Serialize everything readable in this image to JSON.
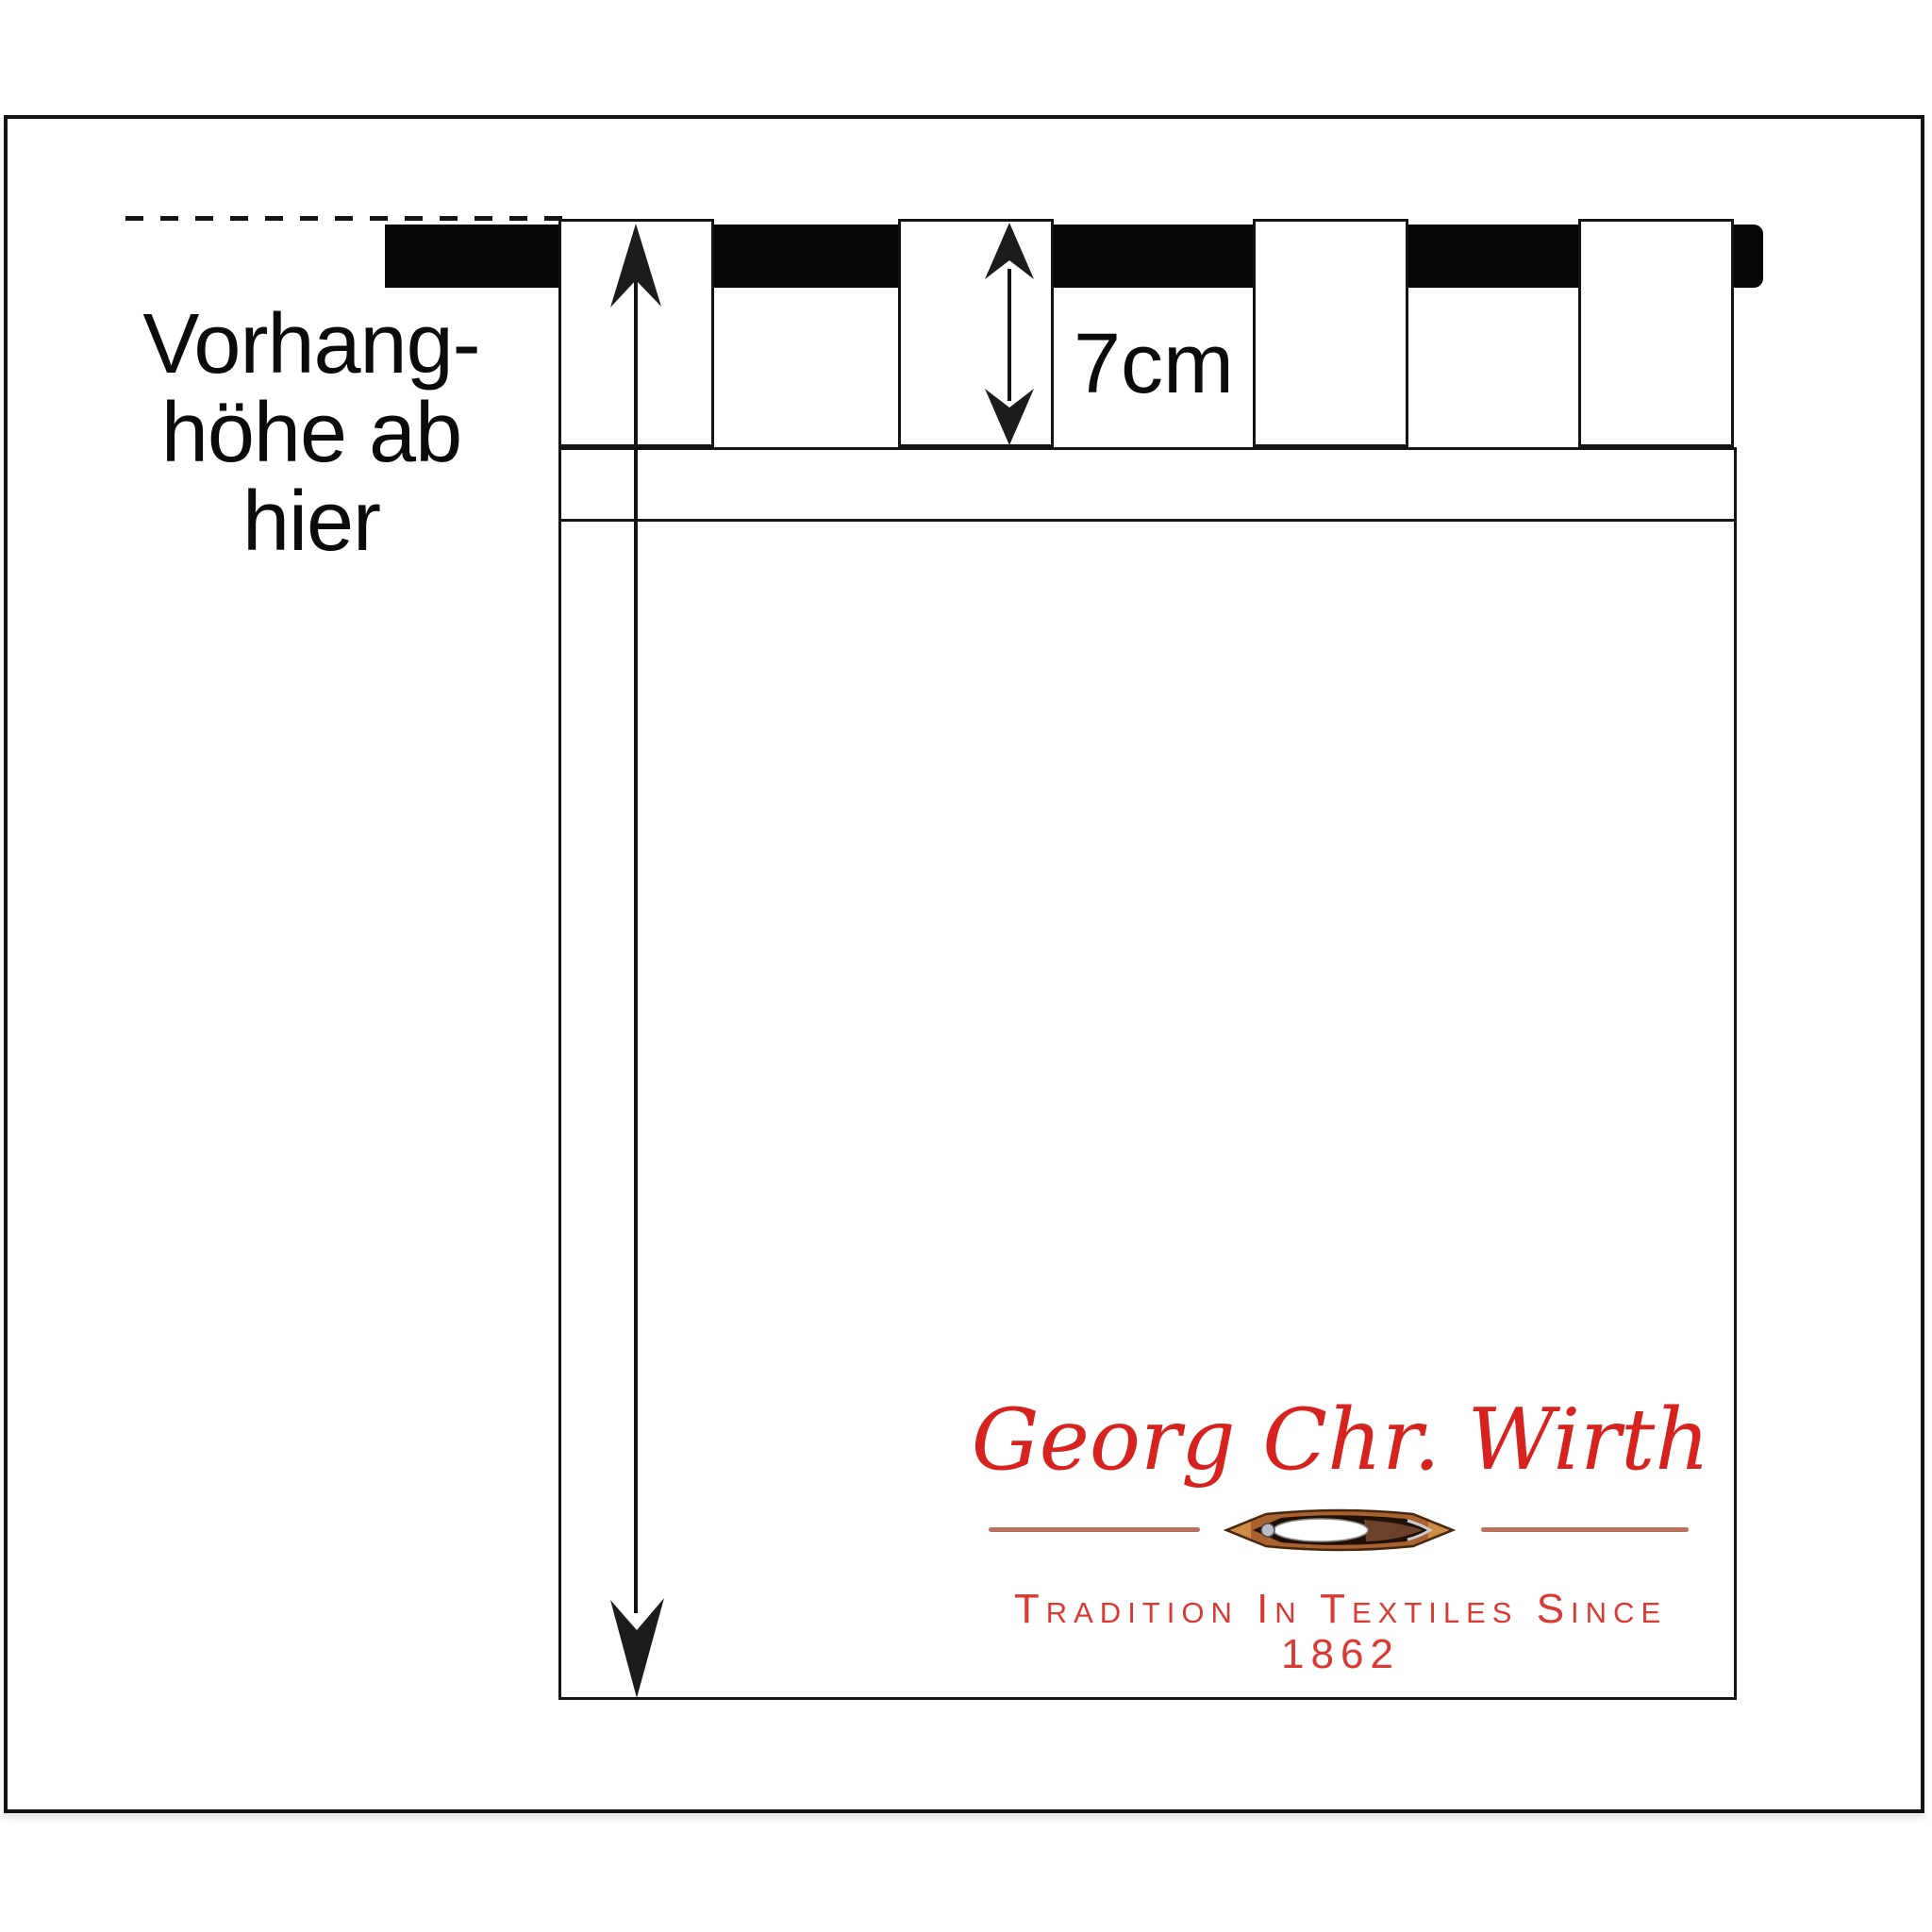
{
  "diagram": {
    "type": "curtain-measurement-diagram",
    "note": {
      "lines": [
        "Vorhang-",
        "höhe ab",
        "hier"
      ]
    },
    "tab_height_label": "7cm",
    "arrows": [
      {
        "name": "curtain-height-arrow",
        "meaning": "full curtain height measured from dashed line to hem"
      },
      {
        "name": "tab-height-arrow",
        "meaning": "tab loop height",
        "value": "7cm"
      }
    ]
  },
  "logo": {
    "brand_name": "Georg Chr. Wirth",
    "tagline": "Tradition In Textiles Since 1862",
    "icon": "weaving-shuttle-icon"
  },
  "colors": {
    "line_black": "#141414",
    "rod_black": "#060606",
    "brand_red": "#d6231f",
    "tagline_red": "#da3a33",
    "separator_rose": "#b9705f",
    "background": "#ffffff"
  }
}
